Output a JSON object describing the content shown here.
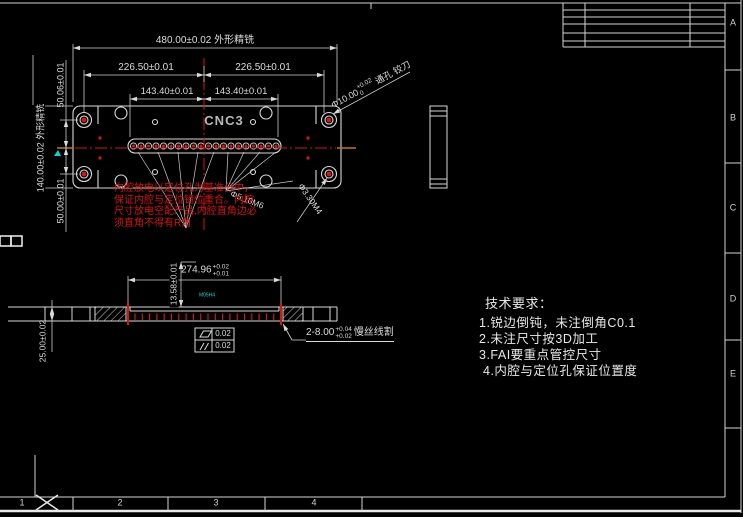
{
  "colors": {
    "background": "#000000",
    "line": "#d4d4d4",
    "dim_text": "#dcdcdc",
    "red": "#d81414",
    "cyan": "#00d8d8",
    "orange": "#c87614"
  },
  "front_view": {
    "machine_label": "CNC3",
    "dim_overall_width": "480.00±0.02 外形精铣",
    "dim_width_left": "226.50±0.01",
    "dim_width_right": "226.50±0.01",
    "dim_inner_left": "143.40±0.01",
    "dim_inner_right": "143.40±0.01",
    "dim_overall_height": "140.00±0.02 外形精铣",
    "dim_height_upper": "50.06±0.01",
    "dim_height_lower": "50.00±0.01",
    "leader_reamed_prefix": "Φ10.00",
    "leader_reamed_tol_upper": "+0.02",
    "leader_reamed_tol_lower": "0",
    "leader_reamed_suffix": "通孔 铰刀",
    "leader_tap_m6": "Φ5.10M6",
    "leader_tap_m4": "Φ3.30M4",
    "red_note_line1": "内腔放电以定位孔为基准分中，",
    "red_note_line2": "保证内腔与定位销位重合。内腔",
    "red_note_line3": "尺寸放电空配产品,内腔直角边必",
    "red_note_line4": "须直角不得有R角"
  },
  "section_view": {
    "dim_cavity_width": "274.96",
    "dim_cavity_tol_upper": "+0.02",
    "dim_cavity_tol_lower": "+0.01",
    "dim_depth": "13.58±0.01",
    "dim_thickness": "25.00±0.02",
    "wire_slot_count_size": "2-8.00",
    "wire_slot_tol_upper": "+0.04",
    "wire_slot_tol_lower": "+0.02",
    "wire_slot_process": "慢丝线割",
    "cavity_note": "M05H4",
    "gdt_flatness_value": "0.02",
    "gdt_parallelism_value": "0.02"
  },
  "tech_requirements": {
    "title": "技术要求：",
    "item1": "1.锐边倒钝，未注倒角C0.1",
    "item2": "2.未注尺寸按3D加工",
    "item3": "3.FAI要重点管控尺寸",
    "item4": "4.内腔与定位孔保证位置度"
  },
  "border": {
    "zone_letter_a": "A",
    "zone_letter_b": "B",
    "zone_letter_c": "C",
    "zone_letter_d": "D",
    "zone_letter_e": "E",
    "zone_number_1": "1",
    "zone_number_2": "2",
    "zone_number_3": "3",
    "zone_number_4": "4"
  }
}
